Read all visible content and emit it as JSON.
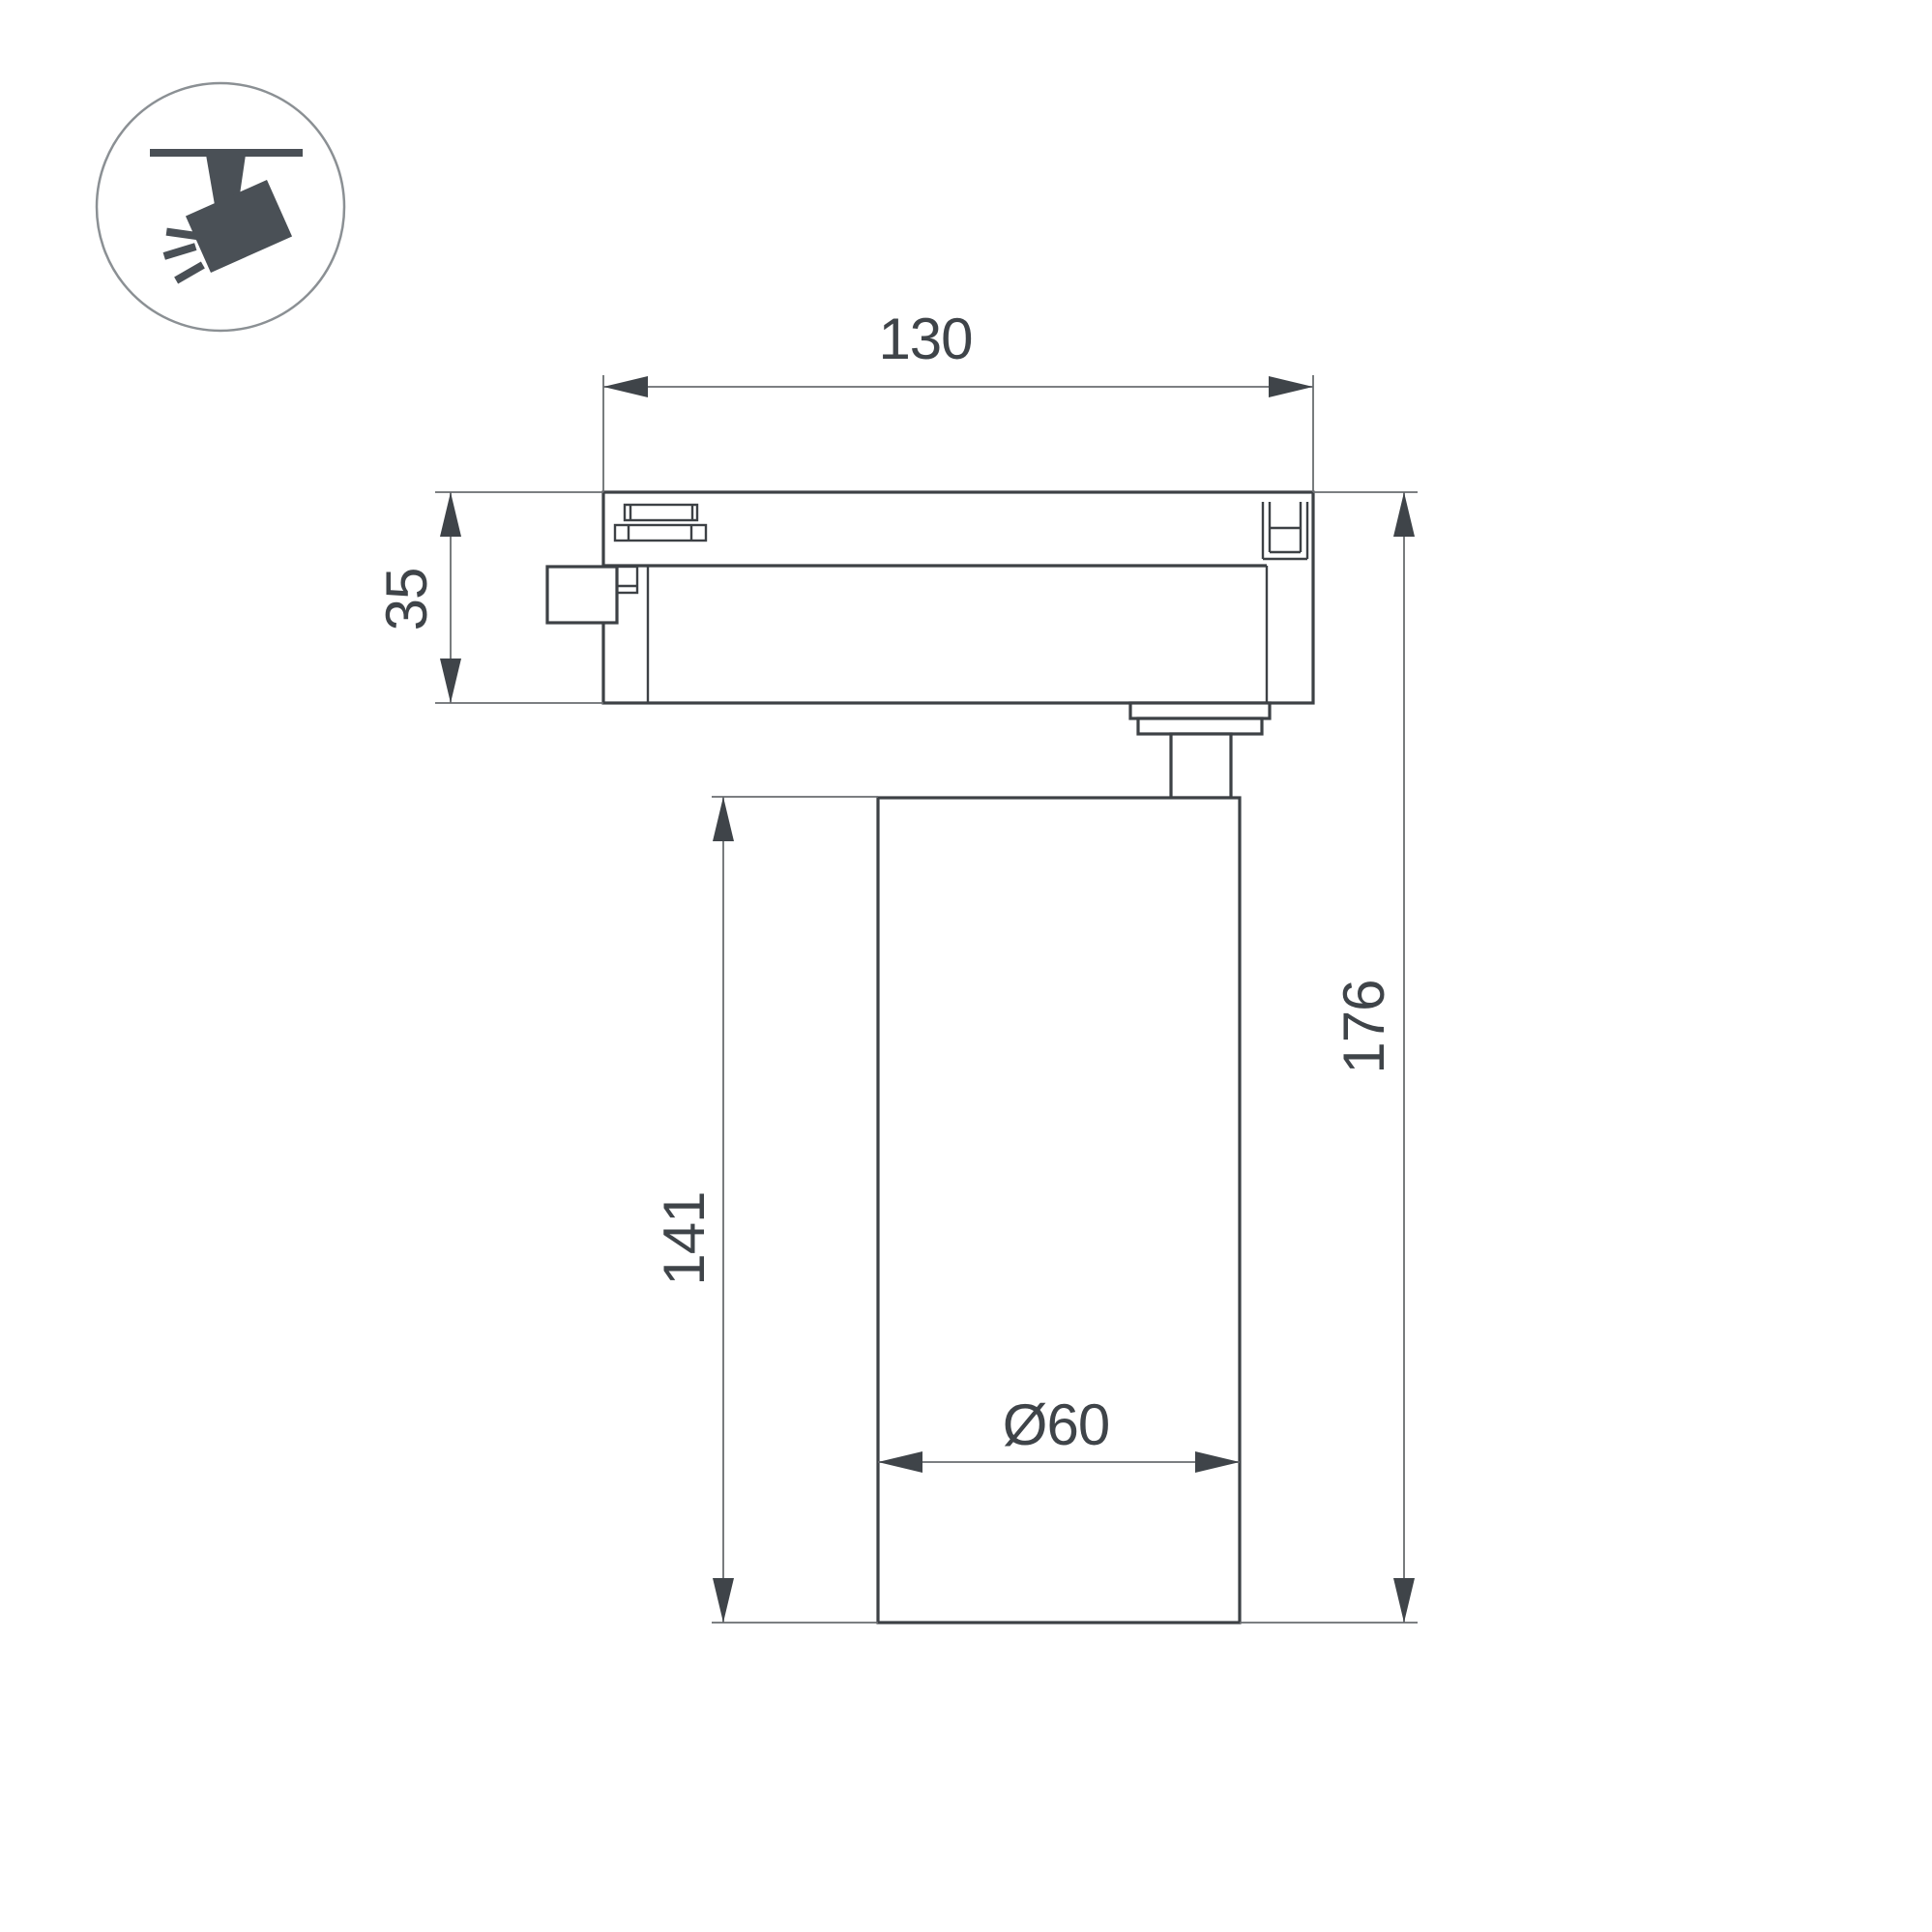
{
  "page": {
    "background": "#ffffff",
    "description": "Technical dimension drawing of LED track spotlight"
  },
  "icon": {
    "name": "track-spotlight-pictogram"
  },
  "dimensions": {
    "adapter_width": {
      "label": "130"
    },
    "adapter_height": {
      "label": "35"
    },
    "body_height": {
      "label": "141"
    },
    "total_height": {
      "label": "176"
    },
    "body_diameter": {
      "label": "Ø60"
    }
  },
  "colors": {
    "outline": "#3d4145",
    "dimension_line": "#6a6d70",
    "text": "#3f4449",
    "icon_fill": "#4a5056",
    "icon_circle_stroke": "#8b9094",
    "background": "#ffffff"
  }
}
